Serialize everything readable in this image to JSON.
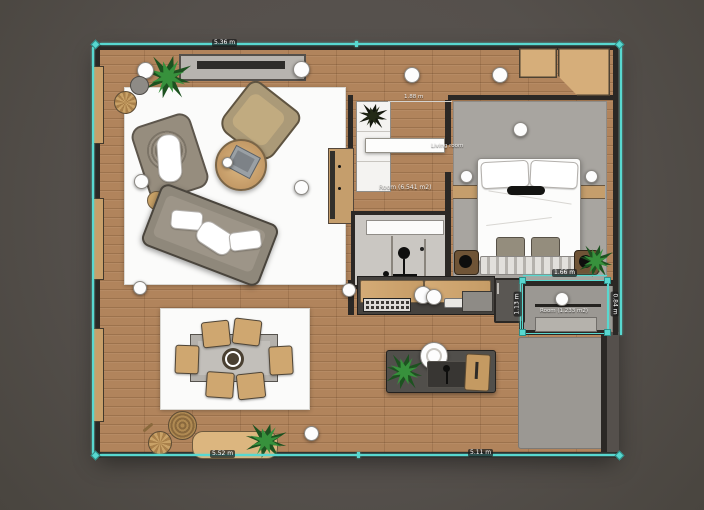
{
  "app": {
    "name": "floor-plan-editor",
    "view": "2d-top-down"
  },
  "theme": {
    "background": "#55504c",
    "wood": "#b1845c",
    "wall": "#2b2825",
    "rug_white": "#fbfbfa",
    "rug_gray": "#a8a5a0",
    "balcony_gray": "#9b9893",
    "selection": "#58d8d0",
    "tan": "#cfa770",
    "sofa": "#8f887b",
    "counter_dark": "#45423e",
    "plant_green": "#37913c"
  },
  "labels": {
    "top_dim": "5.36 m",
    "bottom_left_dim": "5.52 m",
    "bottom_right_dim": "5.11 m",
    "entry_dim": "1.88 m",
    "living_room": "Living room",
    "entry_room": "Room (6.541 m2)",
    "balcony_room": "Room (1.233 m2)",
    "balcony_top_dim": "1.66 m",
    "balcony_left_dim": "1.13 m",
    "balcony_right_dim": "0.84 m"
  },
  "furniture": [
    "tv-console",
    "sofa",
    "armchair",
    "wicker-armchair",
    "coffee-table",
    "laptop",
    "dining-table",
    "dining-chairs",
    "sideboard-bench",
    "kitchen-counter",
    "kitchen-island",
    "sink",
    "stove",
    "fridge",
    "shower",
    "closet",
    "bed",
    "nightstands",
    "wardrobe",
    "bench",
    "plants",
    "ceiling-lamps"
  ]
}
